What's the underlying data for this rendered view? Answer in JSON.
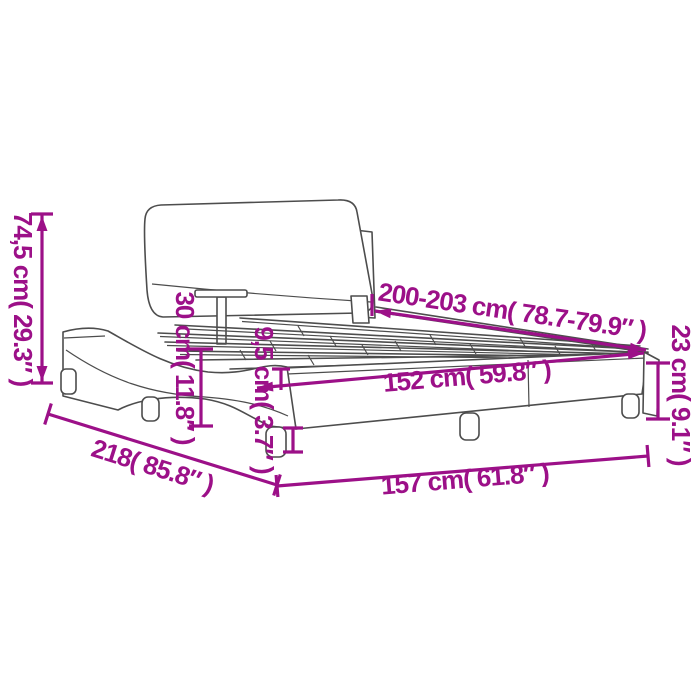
{
  "diagram": {
    "title": "bed frame with headboard dimension diagram",
    "accent_color": "#9C1088",
    "line_color": "#4D4D4D",
    "background_color": "#FFFFFF",
    "labels": {
      "total_height": "74,5 cm( 29.3″ )",
      "headboard_height": "30 cm( 11.8″ )",
      "slat_base_height": "9,5 cm( 3.7″ )",
      "frame_side_height": "23 cm( 9.1″ )",
      "mattress_length": "200-203 cm( 78.7-79.9″ )",
      "mattress_width": "152 cm( 59.8″ )",
      "frame_width": "157 cm( 61.8″ )",
      "total_length": "218( 85.8″ )"
    }
  }
}
